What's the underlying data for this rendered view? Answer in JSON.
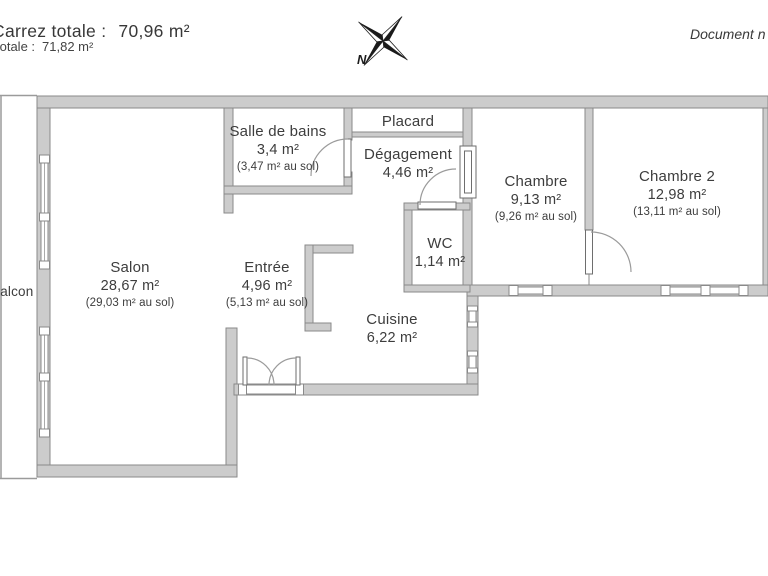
{
  "header": {
    "line1_label": "Carrez totale :",
    "line1_value": "70,96 m²",
    "line2_label": "totale :",
    "line2_value": "71,82 m²",
    "doc_note": "Document n"
  },
  "compass": {
    "north_label": "N"
  },
  "rooms": [
    {
      "id": "salon",
      "name": "Salon",
      "area": "28,67 m²",
      "floor_area": "(29,03 m² au sol)"
    },
    {
      "id": "salle-de-bains",
      "name": "Salle de bains",
      "area": "3,4 m²",
      "floor_area": "(3,47 m² au sol)"
    },
    {
      "id": "placard",
      "name": "Placard",
      "area": "",
      "floor_area": ""
    },
    {
      "id": "degagement",
      "name": "Dégagement",
      "area": "4,46 m²",
      "floor_area": ""
    },
    {
      "id": "chambre",
      "name": "Chambre",
      "area": "9,13 m²",
      "floor_area": "(9,26 m² au sol)"
    },
    {
      "id": "chambre-2",
      "name": "Chambre 2",
      "area": "12,98 m²",
      "floor_area": "(13,11 m² au sol)"
    },
    {
      "id": "wc",
      "name": "WC",
      "area": "1,14 m²",
      "floor_area": ""
    },
    {
      "id": "entree",
      "name": "Entrée",
      "area": "4,96 m²",
      "floor_area": "(5,13 m² au sol)"
    },
    {
      "id": "cuisine",
      "name": "Cuisine",
      "area": "6,22 m²",
      "floor_area": ""
    },
    {
      "id": "balcon",
      "name": "Balcon",
      "area": "",
      "floor_area": ""
    }
  ],
  "colors": {
    "wall_fill": "#cccccc",
    "wall_stroke": "#8a8a8a",
    "text": "#3d3d3d",
    "line": "#9b9b9b"
  }
}
